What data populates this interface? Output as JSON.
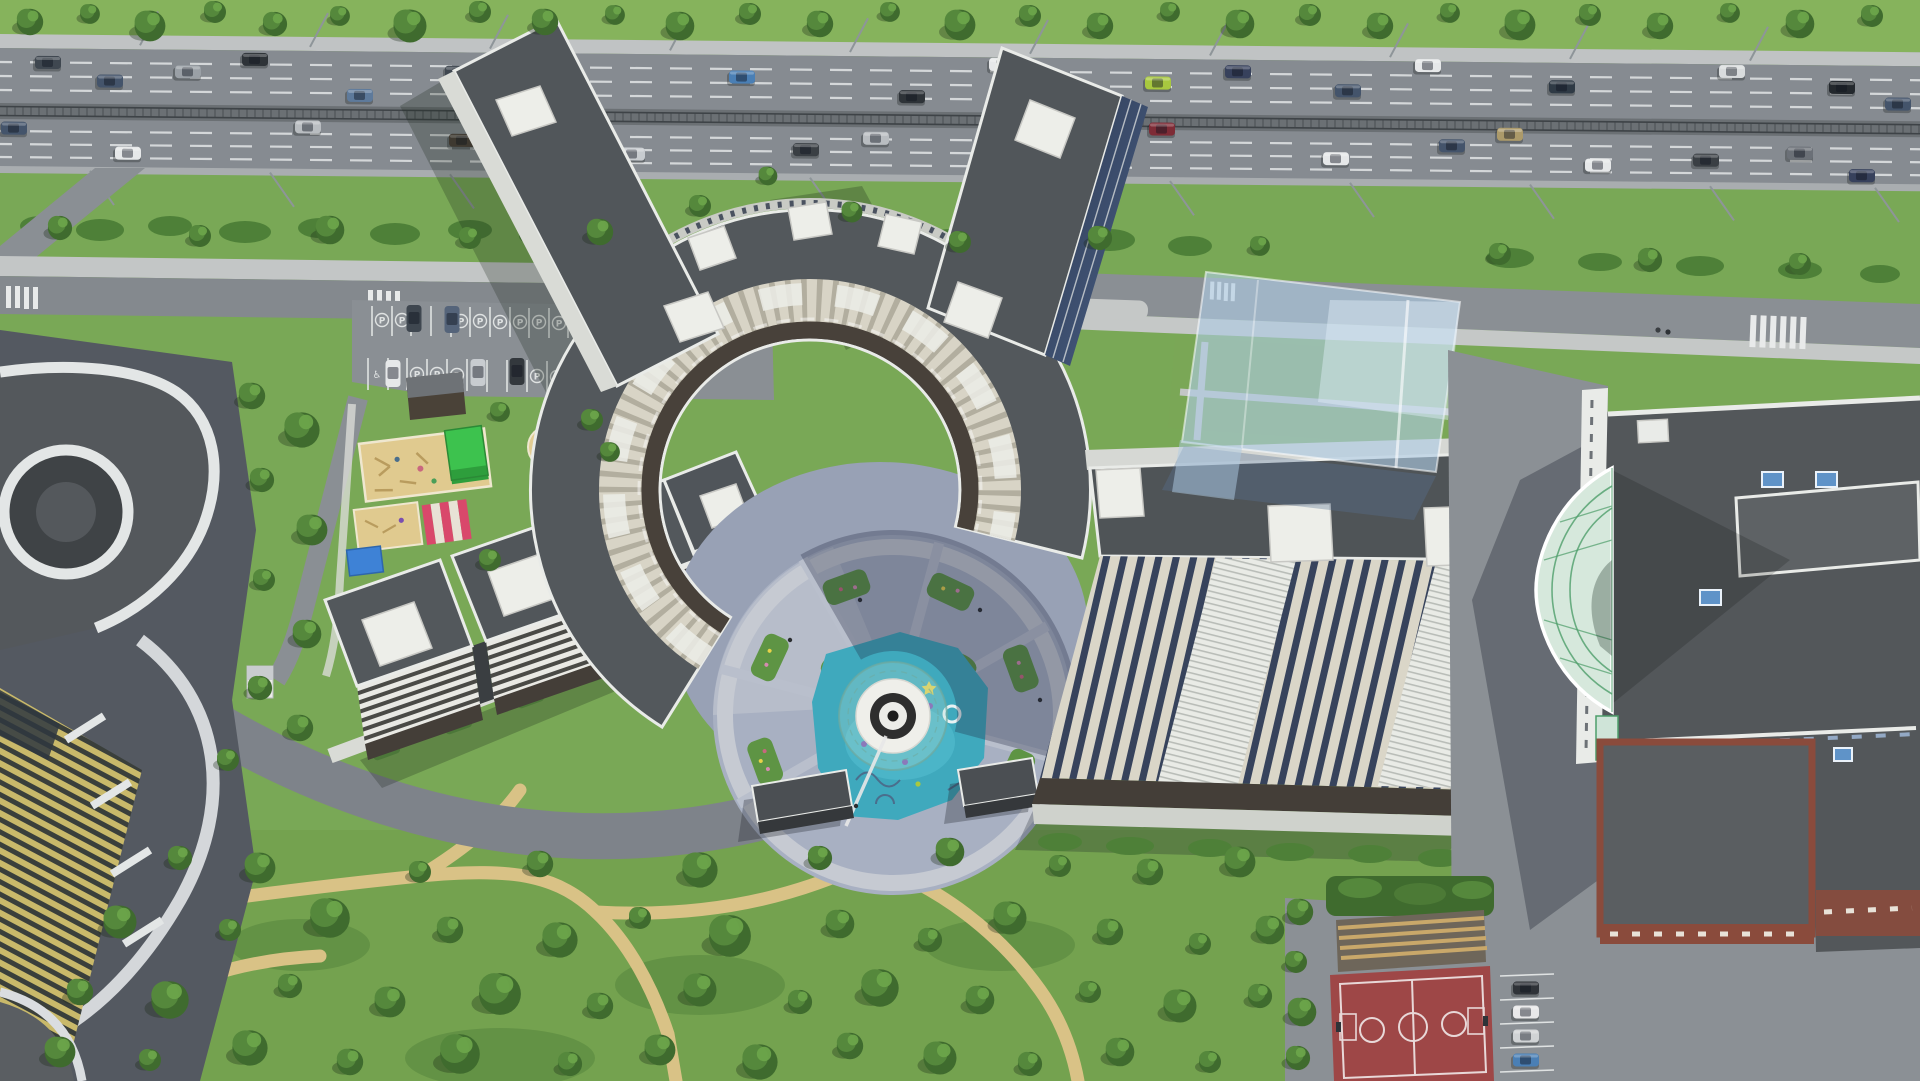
{
  "meta": {
    "description": "Top-down aerial 3D architectural rendering of a residential complex: a large horseshoe-shaped apartment building with two tower wings reaching a multi-lane highway, an inner circular courtyard with splash pad and fountain, stepped apartment blocks and playgrounds to the west, twin tower rows and a shopping mall with glass atrium to the east, a translucent future-phase massing, surface parking, a red basketball court and a large tree park to the south",
    "view": "bird's-eye axonometric",
    "style": "photoreal CGI masterplan visualization"
  },
  "labels": {
    "parking_p": "P",
    "accessible": "♿"
  },
  "palette": {
    "grass": "#79A856",
    "grass_light": "#8CBA64",
    "tree_dark": "#3F6B2E",
    "tree_mid": "#55883C",
    "tree_light": "#6CA44A",
    "asphalt": "#8A8F94",
    "asphalt_dark": "#71767B",
    "median": "#6B7074",
    "lane_marking": "#E2E5E6",
    "sidewalk": "#C3C6C6",
    "sand_path": "#D9C286",
    "play_sand": "#E0CA8F",
    "roof_dark": "#53585C",
    "parapet_white": "#E9EBE8",
    "facade_cream": "#D8D4C6",
    "facade_dark": "#443E38",
    "glass_dark": "#2F3D55",
    "water_turquoise": "#3FA9BD",
    "fountain_white": "#EFEFEA",
    "canopy_green": "#3DC24E",
    "canopy_pink": "#D9486B",
    "canopy_blue": "#3E82D6",
    "court_red": "#9E4747",
    "brick": "#8A4B3C",
    "skylight_blue": "#5F93C8",
    "ghost_blue": "#AFCBE4",
    "yellow_facade": "#C9B96A"
  },
  "scene": {
    "highway": {
      "direction": "east-west",
      "carriageways": 2,
      "lanes_per_side": 4,
      "median": "tram tracks",
      "vehicles": 30,
      "street_lights": true
    },
    "main_building": {
      "shape": "horseshoe ring with two diagonal tower wings",
      "roof": "dark grey with white parapets and rooftop cores"
    },
    "courtyard": {
      "features": [
        "circular plaza",
        "radial paths",
        "planting beds",
        "turquoise splash pad",
        "round white fountain",
        "glass spiral pavilion"
      ]
    },
    "west_cluster": {
      "stepped_blocks": 3,
      "playgrounds": 3,
      "canopies": [
        "green",
        "pink-striped",
        "blue"
      ],
      "parking_rows": 2,
      "accessible_spots": 2
    },
    "east_cluster": {
      "tower_rows": 4,
      "future_phase": "translucent blue massing",
      "mall": {
        "glass_atrium": "green-framed lens",
        "skylights": 4,
        "brick_base": true
      }
    },
    "south": {
      "park": "dense trees with winding sand paths",
      "pavilions": 2,
      "basketball_court": 1,
      "bleachers": true,
      "parked_cars": 4
    }
  }
}
